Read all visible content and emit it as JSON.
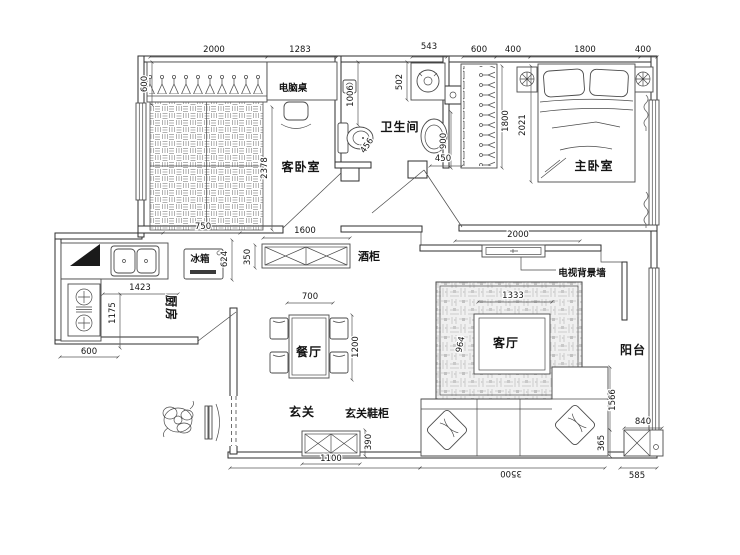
{
  "meta": {
    "drawing_type": "apartment floor plan",
    "language": "zh-CN"
  },
  "rooms": {
    "guest_bedroom": "客卧室",
    "bathroom": "卫生间",
    "master_bedroom": "主卧室",
    "kitchen": "厨房",
    "dining_room": "餐厅",
    "living_room": "客厅",
    "balcony": "阳台",
    "entry": "玄关"
  },
  "furniture": {
    "computer_desk": "电脑桌",
    "fridge": "冰箱",
    "wine_cabinet": "酒柜",
    "tv_background_wall": "电视背景墙",
    "entry_shoe_cabinet": "玄关鞋柜"
  },
  "dimensions_mm": {
    "top": {
      "guest_width": "2000",
      "desk_width": "1283",
      "bath_nook": "543",
      "wardrobe": "600",
      "nightstand_left": "400",
      "bed_width": "1800",
      "nightstand_right": "400"
    },
    "left": {
      "closet_depth": "600",
      "guest_depth": "2378",
      "bed_segment": "750",
      "kitchen_width": "1423",
      "kitchen_depth": "1175",
      "counter_depth": "600"
    },
    "hall": {
      "wine_cabinet_width": "1600",
      "wine_cabinet_depth": "350",
      "fridge_width": "624"
    },
    "bathroom": {
      "shower": "1006",
      "washer": "502",
      "toilet": "456",
      "basin": "900",
      "door": "450"
    },
    "master": {
      "wardrobe_height": "1800",
      "bed_length": "2021"
    },
    "living": {
      "tv_wall": "2000",
      "rug_width": "1333",
      "rug_depth": "964",
      "sofa_depth": "1566",
      "sofa_side": "365",
      "sofa_wall": "3500"
    },
    "dining": {
      "table_width": "700",
      "table_length": "1200"
    },
    "entry": {
      "shoe_cabinet_width": "1100",
      "shoe_cabinet_depth": "390"
    },
    "balcony": {
      "cabinet_width": "840",
      "cabinet_side": "585"
    }
  }
}
